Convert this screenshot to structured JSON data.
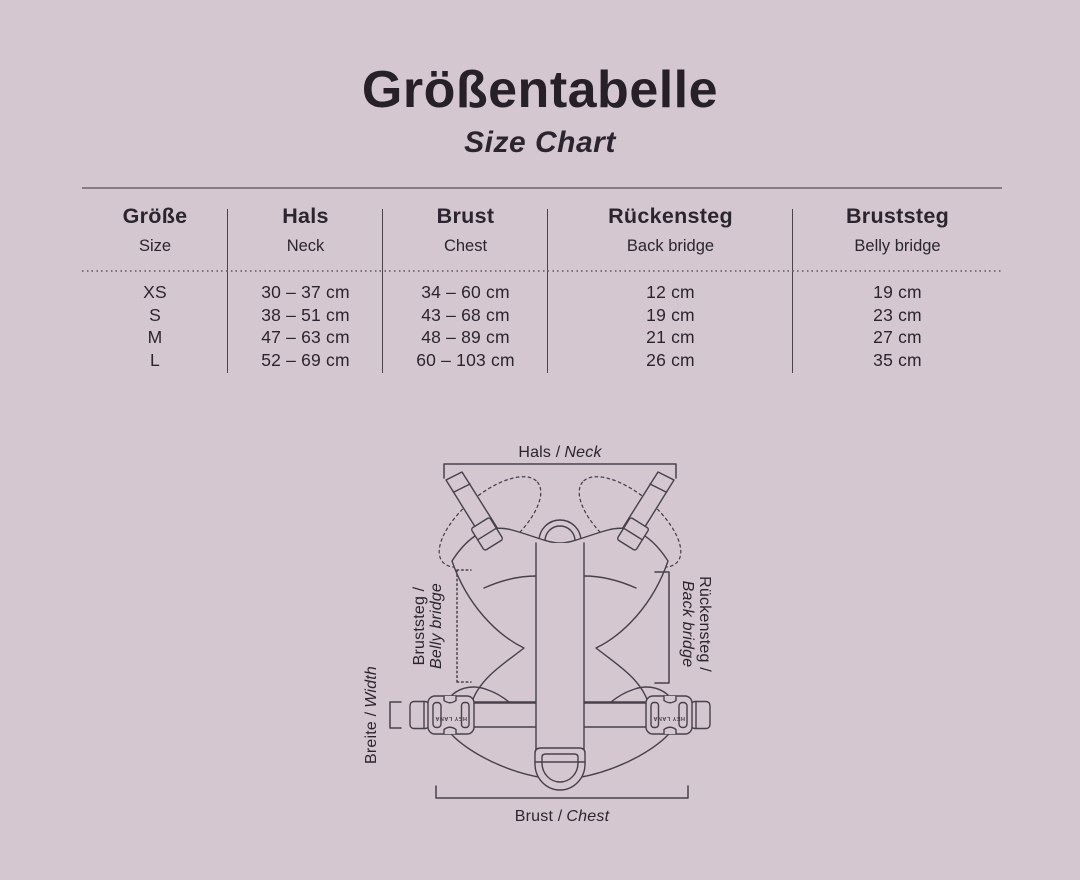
{
  "page": {
    "title": "Größentabelle",
    "subtitle": "Size Chart"
  },
  "colors": {
    "background": "#d4c7d0",
    "ink": "#2b2530",
    "rule": "#867c85",
    "divider": "#4a434c",
    "line_art": "#46404a"
  },
  "table": {
    "columns": [
      {
        "de": "Größe",
        "en": "Size"
      },
      {
        "de": "Hals",
        "en": "Neck"
      },
      {
        "de": "Brust",
        "en": "Chest"
      },
      {
        "de": "Rückensteg",
        "en": "Back bridge"
      },
      {
        "de": "Bruststeg",
        "en": "Belly bridge"
      }
    ],
    "rows": [
      {
        "size": "XS",
        "neck": "30 – 37 cm",
        "chest": "34 – 60 cm",
        "back_bridge": "12 cm",
        "belly_bridge": "19 cm"
      },
      {
        "size": "S",
        "neck": "38 – 51 cm",
        "chest": "43 – 68 cm",
        "back_bridge": "19 cm",
        "belly_bridge": "23 cm"
      },
      {
        "size": "M",
        "neck": "47 – 63 cm",
        "chest": "48 – 89 cm",
        "back_bridge": "21 cm",
        "belly_bridge": "27 cm"
      },
      {
        "size": "L",
        "neck": "52 – 69 cm",
        "chest": "60 – 103 cm",
        "back_bridge": "26 cm",
        "belly_bridge": "35 cm"
      }
    ]
  },
  "diagram": {
    "labels": {
      "neck": {
        "de": "Hals /",
        "en": "Neck"
      },
      "chest": {
        "de": "Brust /",
        "en": "Chest"
      },
      "belly_bridge": {
        "de": "Bruststeg /",
        "en": "Belly bridge"
      },
      "back_bridge": {
        "de": "Rückensteg /",
        "en": "Back bridge"
      },
      "width": {
        "de": "Breite /",
        "en": "Width"
      }
    },
    "buckle_text": "HEY LANA"
  }
}
